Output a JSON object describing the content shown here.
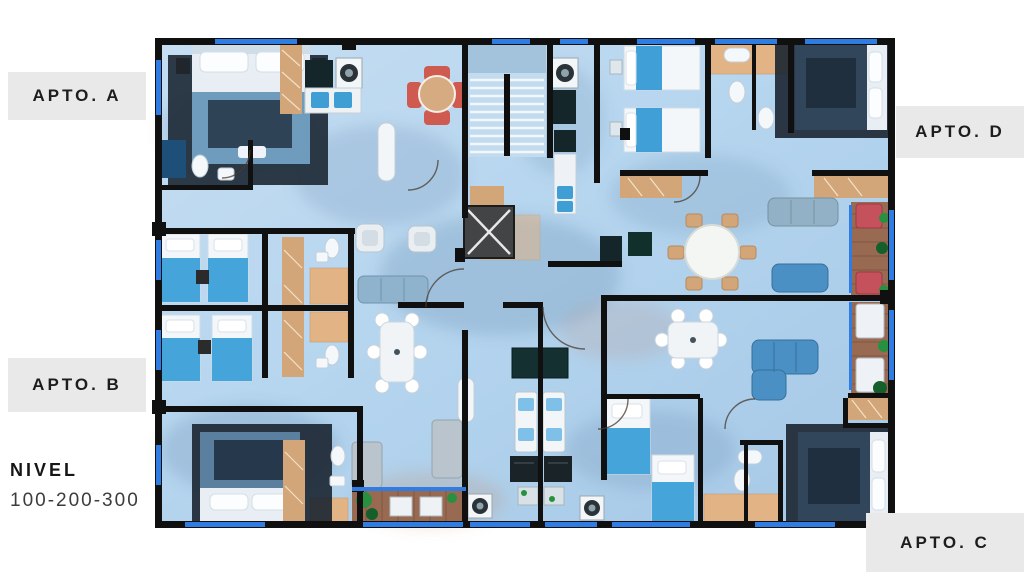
{
  "labels": {
    "a": "APTO. A",
    "b": "APTO. B",
    "c": "APTO. C",
    "d": "APTO. D"
  },
  "level": {
    "title": "NIVEL",
    "value": "100-200-300"
  },
  "floorplan": {
    "type": "residential-apartment-floor-plan",
    "view": "top-down-3d-render",
    "units": [
      "A",
      "B",
      "C",
      "D"
    ],
    "core_elements": [
      "stairs",
      "elevator"
    ],
    "furniture_icons": [
      "double-bed",
      "twin-bed",
      "sofa",
      "armchair",
      "dining-table",
      "round-table",
      "red-dining-set",
      "kitchen-counter",
      "sink",
      "washer",
      "fridge",
      "toilet",
      "shower",
      "closet",
      "balcony-deck",
      "lounger",
      "plant"
    ]
  },
  "colors": {
    "background": "#ffffff",
    "label_bg": "#e9e9e9",
    "label_text": "#1d1d1d",
    "floor_blue": "#b7d6ee",
    "wall_black": "#101010",
    "window_blue": "#2f7ce2",
    "wood_tan": "#d2a678",
    "deck_brown": "#996a52",
    "bed_blue": "#45a4da",
    "sofa_blue": "#4a90c4",
    "accent_red": "#ce5a50",
    "plant_green": "#27913f"
  }
}
